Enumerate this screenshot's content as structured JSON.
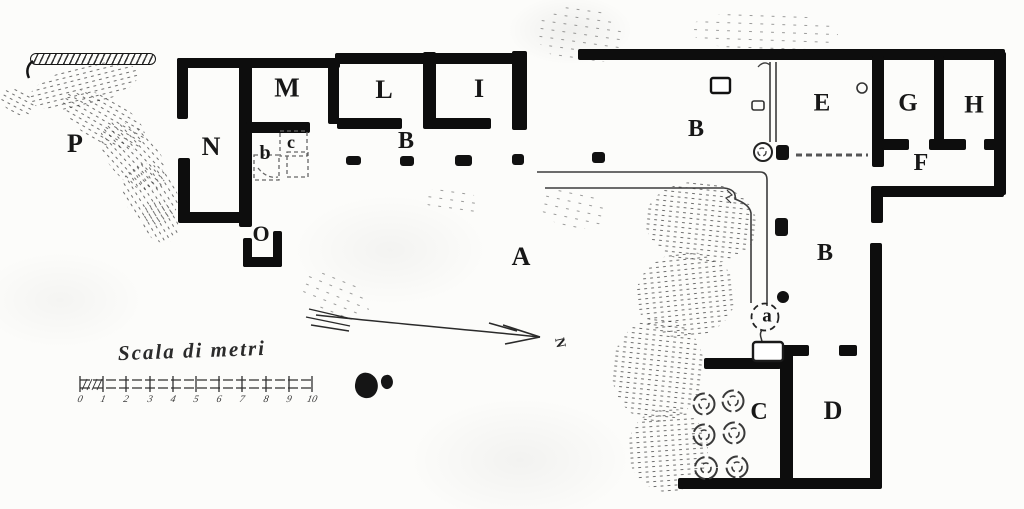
{
  "plan": {
    "room_labels": {
      "P": "P",
      "N": "N",
      "M": "M",
      "b": "b",
      "c": "c",
      "O": "O",
      "B_portico": "B",
      "L": "L",
      "I": "I",
      "B_courtyard": "B",
      "A": "A",
      "E": "E",
      "G": "G",
      "H": "H",
      "F": "F",
      "B_lower": "B",
      "a": "a",
      "C": "C",
      "D": "D"
    },
    "compass": {
      "north_label": "N"
    },
    "scale_bar": {
      "title": "Scala di metri",
      "tick_labels": [
        "0",
        "1",
        "2",
        "3",
        "4",
        "5",
        "6",
        "7",
        "8",
        "9",
        "10"
      ]
    },
    "colors": {
      "ink": "#141414",
      "paper": "#fcfcfa",
      "thin_line": "#3c3c3c"
    }
  }
}
